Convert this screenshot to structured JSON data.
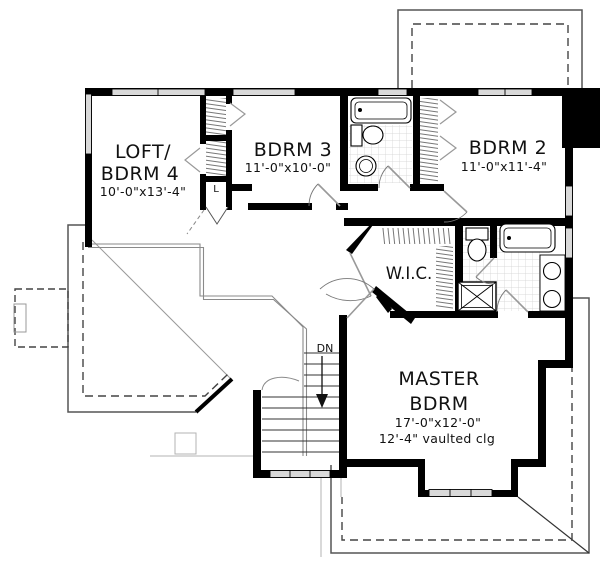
{
  "plan": {
    "type": "second-floor-plan",
    "rooms": {
      "loft": {
        "name1": "LOFT/",
        "name2": "BDRM 4",
        "dims": "10'-0\"x13'-4\""
      },
      "bdrm3": {
        "name": "BDRM 3",
        "dims": "11'-0\"x10'-0\""
      },
      "bdrm2": {
        "name": "BDRM 2",
        "dims": "11'-0\"x11'-4\""
      },
      "wic": {
        "name": "W.I.C."
      },
      "master": {
        "name1": "MASTER",
        "name2": "BDRM",
        "dims": "17'-0\"x12'-0\"",
        "ceiling_note": "12'-4\" vaulted clg"
      }
    },
    "stairs": {
      "down_label": "DN"
    },
    "closets": {
      "linen_label": "L"
    },
    "colors": {
      "background": "#ffffff",
      "wall": "#000000",
      "thin_line": "#333333",
      "roof_solid": "#555555",
      "roof_dashed": "#444444",
      "railing": "#8a8a8a",
      "tile": "#d0d0d0",
      "window_fill": "#d9d9d9",
      "ghost": "#b3b3b3",
      "hatch": "#777777"
    }
  }
}
